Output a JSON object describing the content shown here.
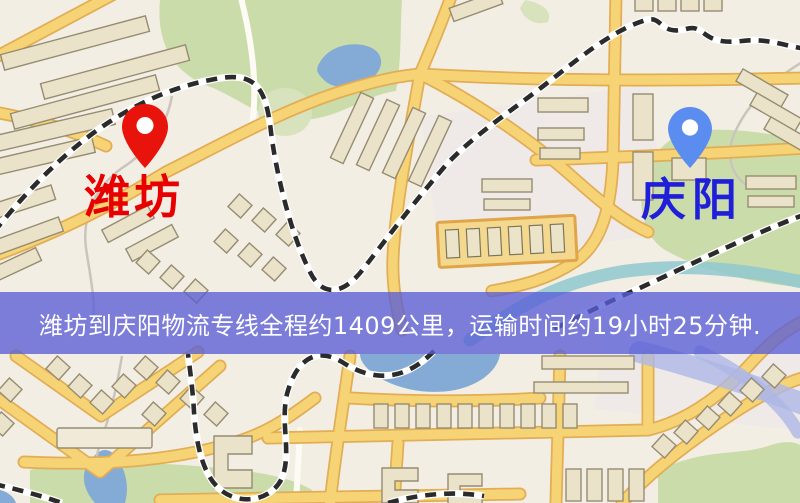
{
  "map": {
    "origin_marker": {
      "name": "潍坊",
      "pin_color": "#e8140c",
      "label_color": "#e80000",
      "icon": "map-pin-icon"
    },
    "destination_marker": {
      "name": "庆阳",
      "pin_color": "#5b8cf0",
      "label_color": "#1f1fd9",
      "icon": "map-pin-icon"
    },
    "colors": {
      "background": "#f3eee4",
      "park": "#cbdcab",
      "water": "#84abd6",
      "road": "#f6d475",
      "road_casing": "#e2ad55",
      "minor_road": "#fdfbf4",
      "railway": "#2b2b2b",
      "building": "#eae3c9",
      "building_outline": "#968c72",
      "stream": "#8fc8cf",
      "highway": "#aeb6e6"
    }
  },
  "route": {
    "origin": "潍坊",
    "destination": "庆阳",
    "distance": "约1409公里",
    "duration": "约19小时25分钟"
  },
  "banner": {
    "text": "潍坊到庆阳物流专线全程约1409公里，运输时间约19小时25分钟.",
    "background": "rgba(88,94,214,0.78)",
    "text_color": "#ffffff"
  }
}
